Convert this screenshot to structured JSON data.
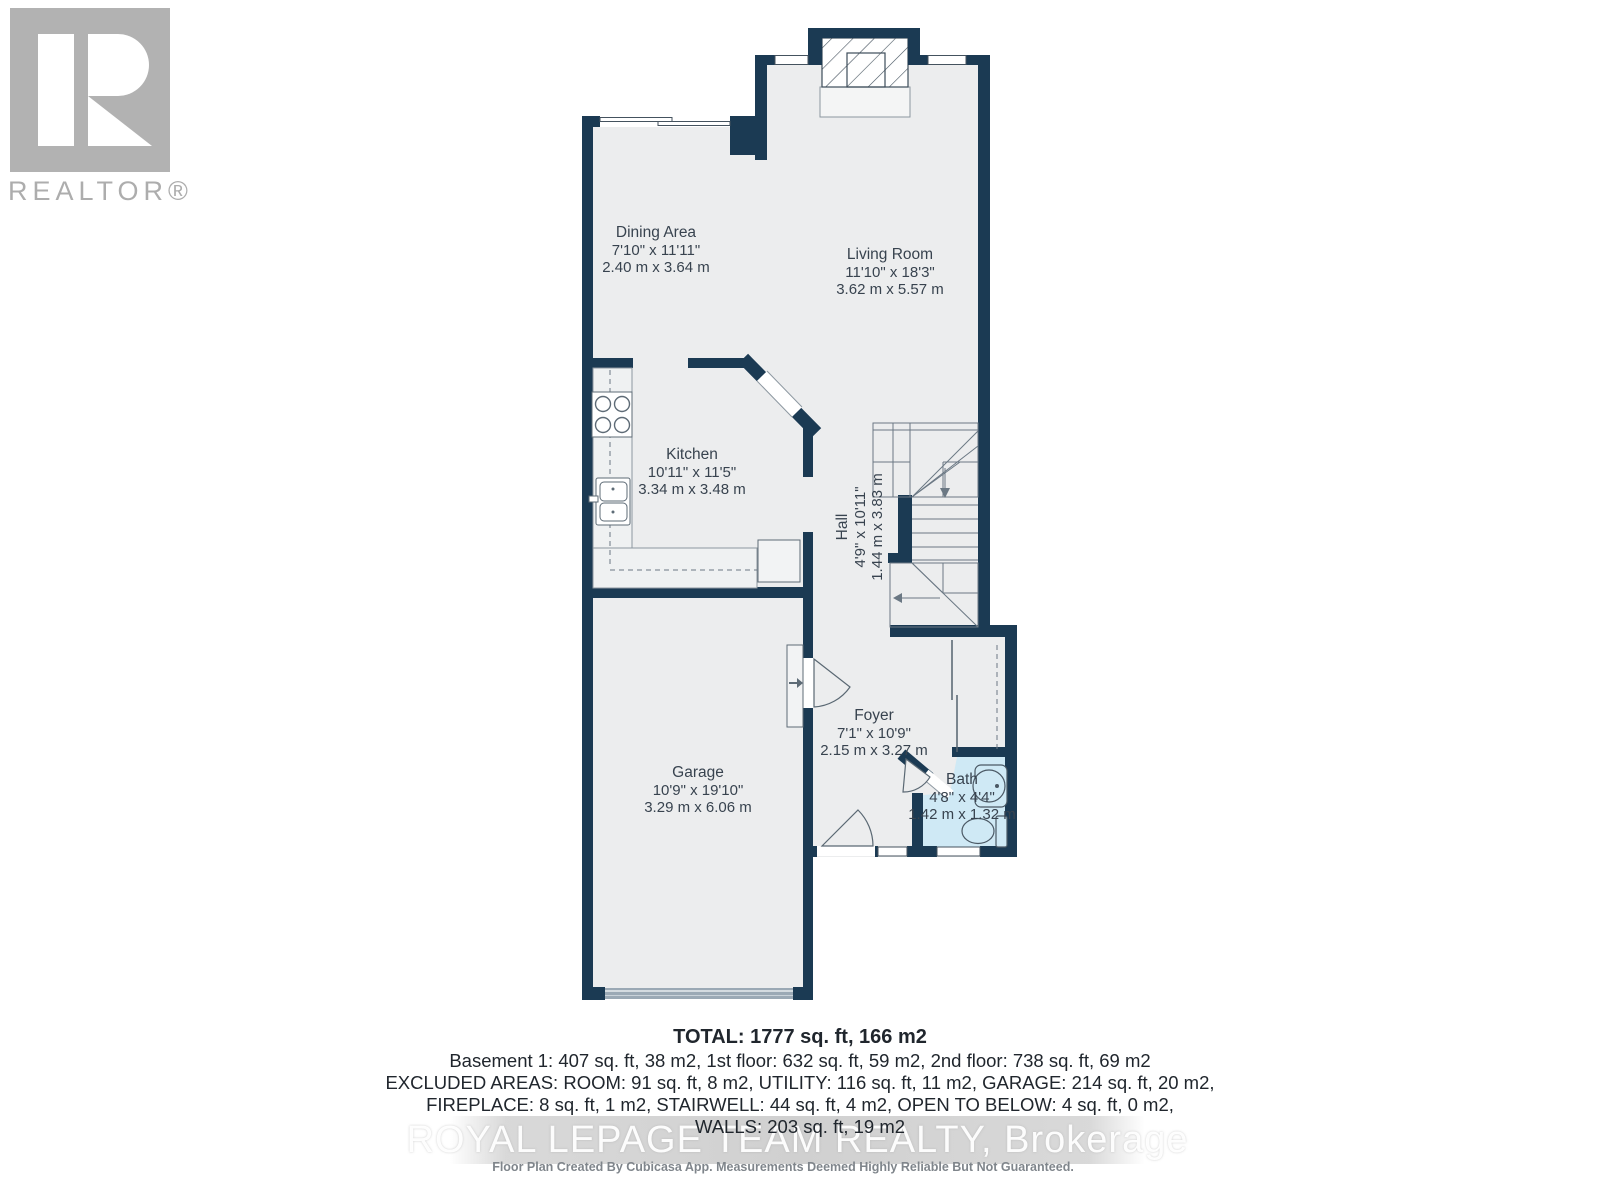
{
  "branding": {
    "realtor_logo_text": "REALTOR®"
  },
  "rooms": {
    "dining": {
      "name": "Dining Area",
      "imperial": "7'10\" x 11'11\"",
      "metric": "2.40 m x 3.64 m"
    },
    "living": {
      "name": "Living Room",
      "imperial": "11'10\" x 18'3\"",
      "metric": "3.62 m x 5.57 m"
    },
    "kitchen": {
      "name": "Kitchen",
      "imperial": "10'11\" x 11'5\"",
      "metric": "3.34 m x 3.48 m"
    },
    "hall": {
      "name": "Hall",
      "imperial": "4'9\" x 10'11\"",
      "metric": "1.44 m x 3.83 m"
    },
    "foyer": {
      "name": "Foyer",
      "imperial": "7'1\" x 10'9\"",
      "metric": "2.15 m x 3.27 m"
    },
    "garage": {
      "name": "Garage",
      "imperial": "10'9\" x 19'10\"",
      "metric": "3.29 m x 6.06 m"
    },
    "bath": {
      "name": "Bath",
      "imperial": "4'8\" x 4'4\"",
      "metric": "1.42 m x 1.32 m"
    }
  },
  "summary": {
    "total": "TOTAL: 1777 sq. ft, 166 m2",
    "line1": "Basement 1: 407 sq. ft, 38 m2, 1st floor: 632 sq. ft, 59 m2, 2nd floor: 738 sq. ft, 69 m2",
    "line2": "EXCLUDED AREAS: ROOM: 91 sq. ft, 8 m2, UTILITY: 116 sq. ft, 11 m2, GARAGE: 214 sq. ft, 20 m2,",
    "line3": "FIREPLACE: 8 sq. ft, 1 m2, STAIRWELL: 44 sq. ft, 4 m2, OPEN TO BELOW: 4 sq. ft, 0 m2,",
    "line4": "WALLS: 203 sq. ft, 19 m2"
  },
  "watermark": "ROYAL LEPAGE TEAM REALTY, Brokerage",
  "disclaimer": "Floor Plan Created By Cubicasa App. Measurements Deemed Highly Reliable But Not Guaranteed.",
  "colors": {
    "wall": "#1B3A53",
    "floor": "#ECEDEE",
    "bath_floor": "#CFE9F5",
    "garage_door": "#9BA9B5",
    "fixture_line": "#4A5864",
    "stair_line": "#6B7884",
    "label_text": "#38434F",
    "logo_gray": "#B2B2B2"
  }
}
